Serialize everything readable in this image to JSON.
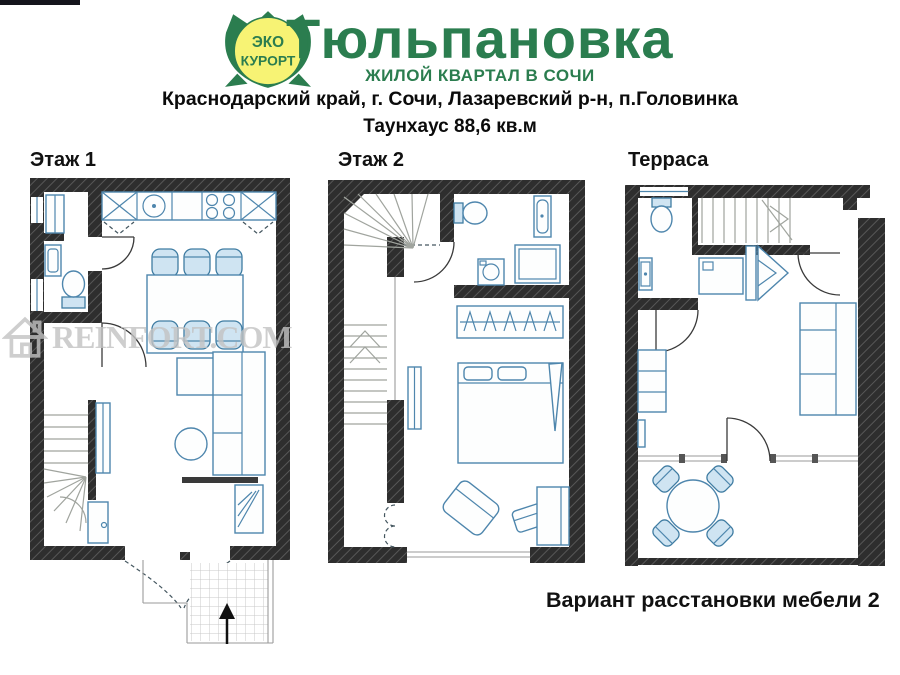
{
  "header": {
    "badge": {
      "line1": "ЭКО",
      "line2": "КУРОРТ"
    },
    "title": "Тюльпановка",
    "subtitle": "ЖИЛОЙ КВАРТАЛ В СОЧИ",
    "address": "Краснодарский край, г. Сочи, Лазаревский р-н, п.Головинка",
    "area": "Таунхаус 88,6 кв.м"
  },
  "plans": [
    {
      "label": "Этаж 1",
      "elements": [
        "entry-hall-closet",
        "bathroom-toilet",
        "bathroom-basin",
        "kitchen-counter",
        "sink",
        "stove",
        "dining-table-six-chairs",
        "corner-sofa",
        "coffee-table",
        "tv-unit",
        "winder-stairs",
        "entry-porch",
        "entry-arrow"
      ]
    },
    {
      "label": "Этаж 2",
      "elements": [
        "winder-stairs",
        "straight-stairs",
        "bathroom-toilet",
        "vanity",
        "washing-machine",
        "shower",
        "wardrobe-hangers",
        "double-bed",
        "dresser",
        "armchair",
        "ottoman",
        "desk",
        "window"
      ]
    },
    {
      "label": "Терраса",
      "elements": [
        "stairs",
        "bathroom-toilet",
        "washbasin",
        "shower-cabin",
        "wardrobe",
        "sofa",
        "cabinet",
        "glass-wall-door",
        "round-table-four-chairs"
      ]
    }
  ],
  "watermark": {
    "text": "REINFORT.COM"
  },
  "caption": "Вариант расстановки мебели 2",
  "colors": {
    "brand_green": "#2b7d4f",
    "badge_yellow": "#f7f374",
    "furniture_blue": "#4e86ad",
    "wall_dark": "#2e2e2e",
    "watermark_gray": "#c3c3c3"
  }
}
